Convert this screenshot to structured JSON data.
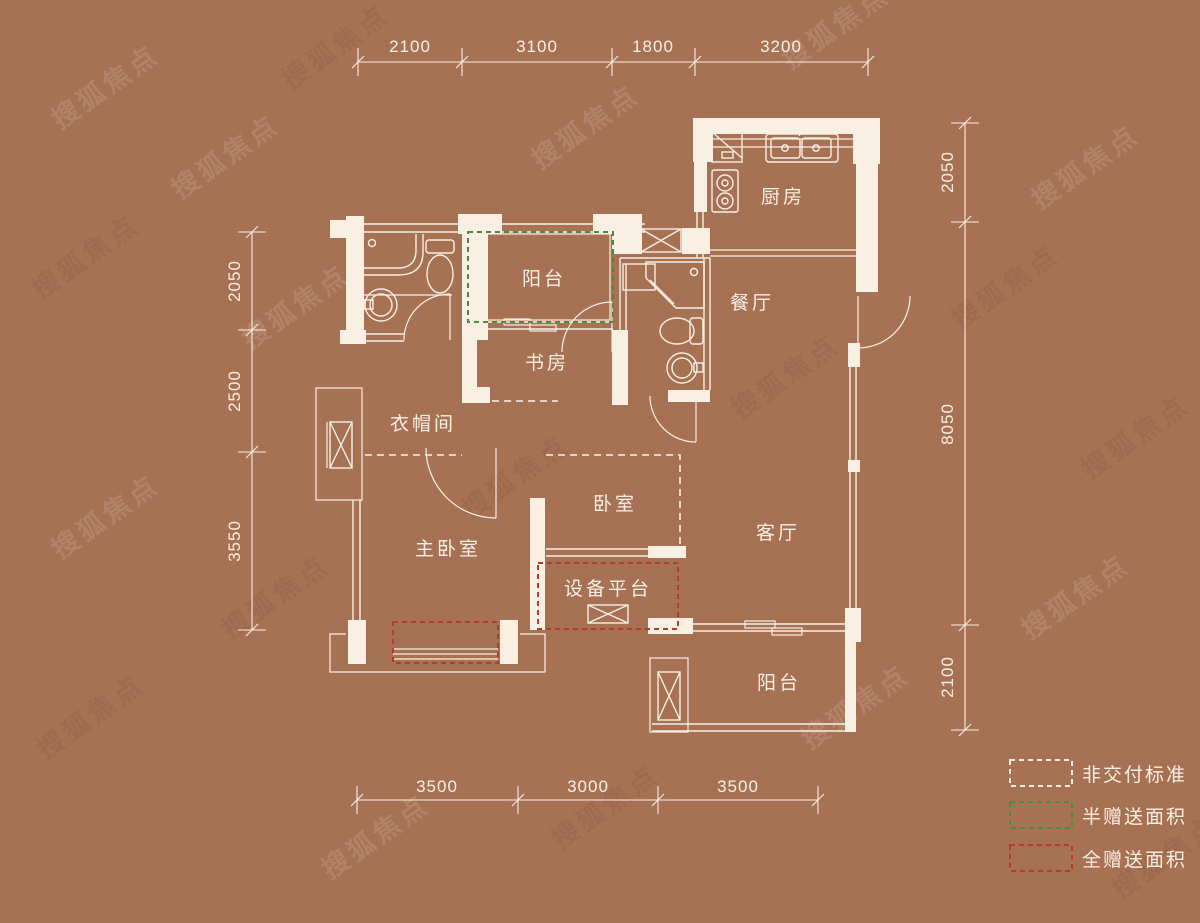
{
  "page": {
    "background": "#a77154",
    "line_color": "#f9efe3"
  },
  "watermark": {
    "text": "搜狐焦点"
  },
  "rooms": {
    "kitchen": "厨房",
    "balcony_top": "阳台",
    "dining": "餐厅",
    "study": "书房",
    "cloakroom": "衣帽间",
    "master_bedroom": "主卧室",
    "bedroom": "卧室",
    "equipment_platform": "设备平台",
    "living_room": "客厅",
    "balcony_bottom": "阳台"
  },
  "dimensions": {
    "top": [
      "2100",
      "3100",
      "1800",
      "3200"
    ],
    "bottom": [
      "3500",
      "3000",
      "3500"
    ],
    "left": [
      "2050",
      "2500",
      "3550"
    ],
    "right": [
      "2050",
      "8050",
      "2100"
    ]
  },
  "legend": [
    {
      "label": "非交付标准",
      "color": "#f9efe3"
    },
    {
      "label": "半赠送面积",
      "color": "#4d8a3d"
    },
    {
      "label": "全赠送面积",
      "color": "#b23b2b"
    }
  ]
}
